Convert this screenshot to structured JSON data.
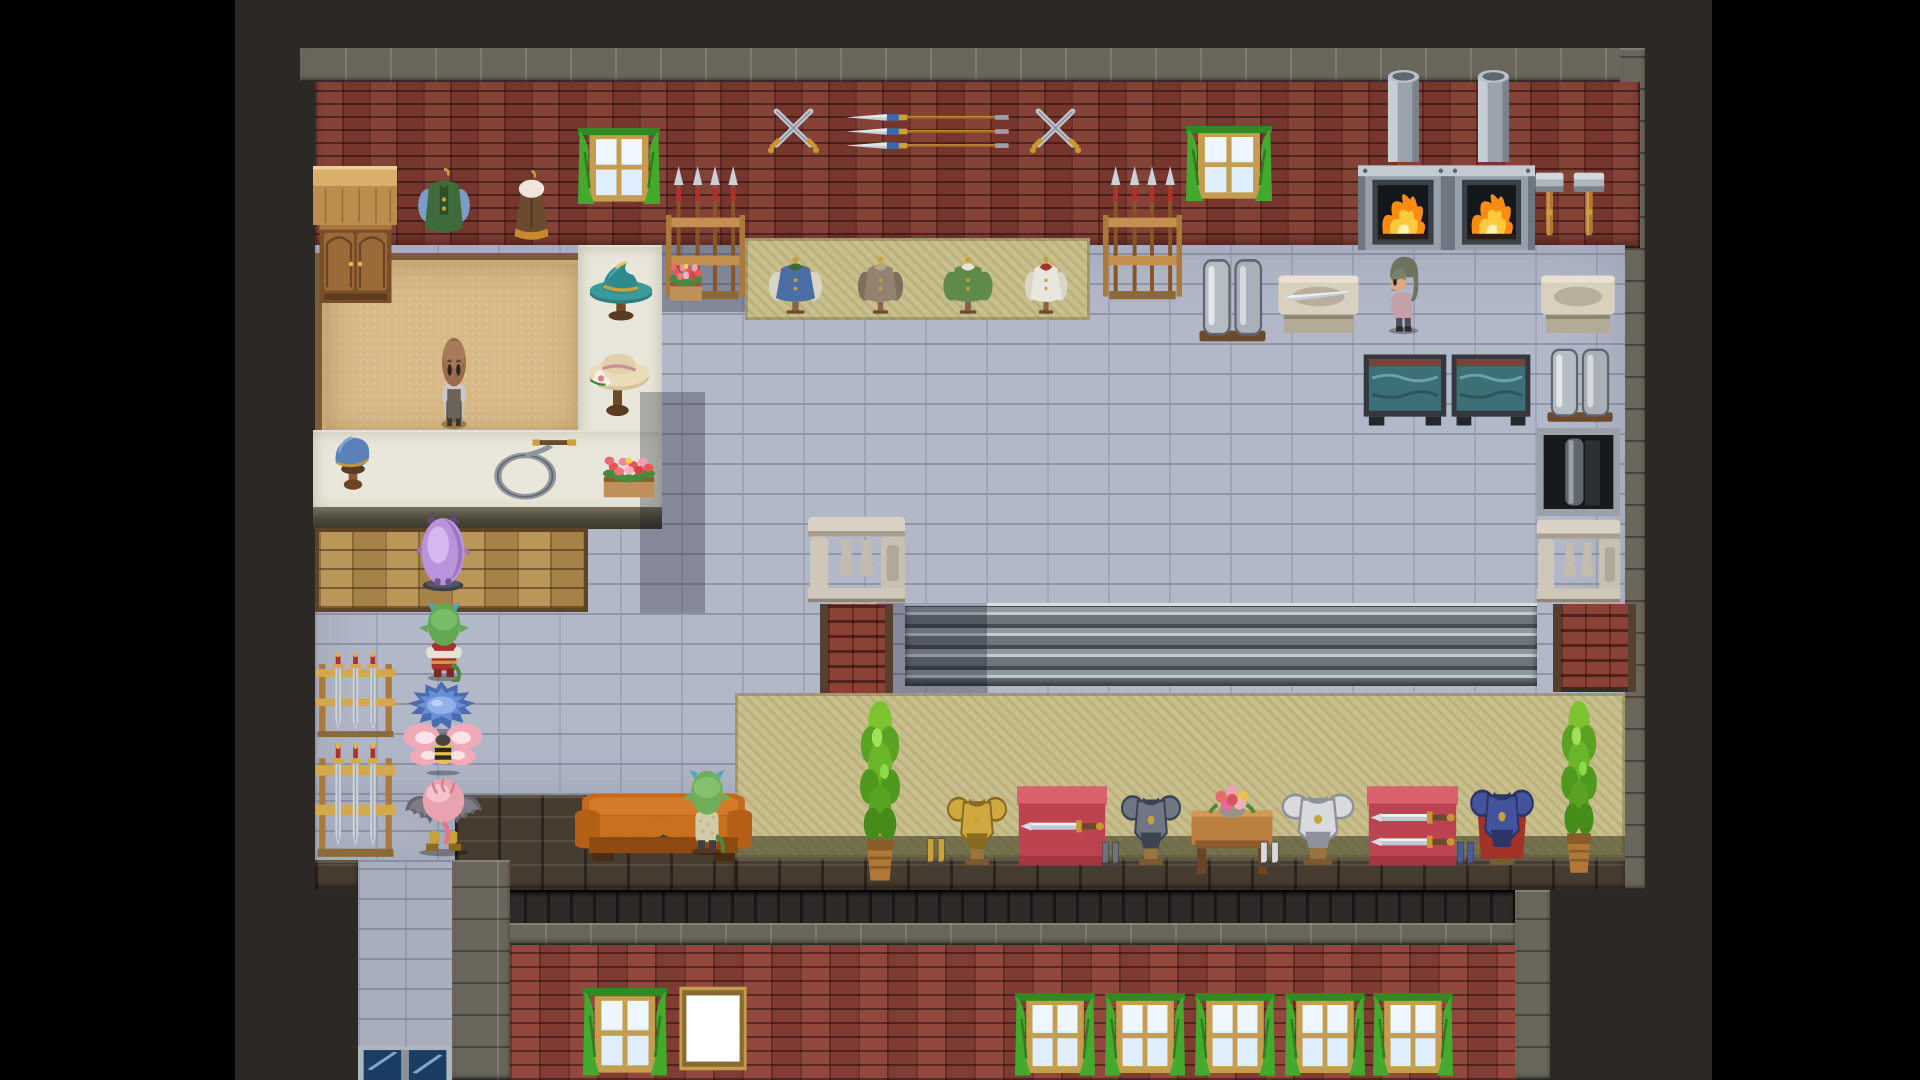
{
  "meta": {
    "screen": {
      "width": 1920,
      "height": 1080
    },
    "scene_kind": "top-down tile RPG shop interior (weapon / armor smithy)",
    "letterbox_color": "#000000"
  },
  "palette": {
    "outer_dark_brick": "#2b2826",
    "stone_trim": "#6a665c",
    "wall_red_brick": "#7d3a31",
    "floor_tile": "#b2b8c8",
    "carpet_tan": "#d7b988",
    "carpet_khaki": "#c8bf8c",
    "counter_white": "#e9e7db",
    "wood": "#9a6a38",
    "curtain_green": "#43aa2e",
    "fire_orange": "#ff8c12",
    "water_teal": "#3c6f76",
    "couch_orange": "#c2691e",
    "metal_gray": "#9aa1a7"
  },
  "scene": {
    "elements": [
      {
        "name": "letterbox-left",
        "type": "black",
        "x": 0,
        "y": 0,
        "w": 235,
        "h": 1080,
        "i": false
      },
      {
        "name": "letterbox-right",
        "type": "black",
        "x": 1712,
        "y": 0,
        "w": 208,
        "h": 1080,
        "i": false
      },
      {
        "name": "outer-wall-dark-brick",
        "type": "darkbrick",
        "x": 235,
        "y": 0,
        "w": 1477,
        "h": 1080,
        "i": false
      },
      {
        "name": "building-top-trim",
        "type": "trim",
        "x": 300,
        "y": 48,
        "w": 1345,
        "h": 34,
        "i": false
      },
      {
        "name": "right-trim-column",
        "type": "trim",
        "x": 1620,
        "y": 48,
        "w": 25,
        "h": 842,
        "i": false
      },
      {
        "name": "upper-wall-red-brick",
        "type": "redbrick",
        "x": 315,
        "y": 82,
        "w": 1325,
        "h": 166,
        "i": false
      },
      {
        "name": "main-floor",
        "type": "floor",
        "x": 315,
        "y": 245,
        "w": 1310,
        "h": 550,
        "i": false
      },
      {
        "name": "floor-extension-left",
        "type": "floor",
        "x": 315,
        "y": 795,
        "w": 140,
        "h": 67,
        "i": false
      },
      {
        "name": "walkway-south",
        "type": "floor2",
        "x": 358,
        "y": 862,
        "w": 94,
        "h": 218,
        "i": false
      },
      {
        "name": "bottom-ledge-left",
        "type": "ledgebrick",
        "x": 455,
        "y": 795,
        "w": 280,
        "h": 95,
        "i": false
      },
      {
        "name": "bottom-ledge-stub",
        "type": "ledgebrick",
        "x": 315,
        "y": 860,
        "w": 43,
        "h": 30,
        "i": false
      },
      {
        "name": "bottom-ledge-right",
        "type": "ledgebrick",
        "x": 735,
        "y": 858,
        "w": 890,
        "h": 32,
        "i": false
      },
      {
        "name": "bottom-planked-band",
        "type": "planks",
        "x": 455,
        "y": 890,
        "w": 1060,
        "h": 33,
        "i": false
      },
      {
        "name": "bottom-trim-row",
        "type": "trim",
        "x": 455,
        "y": 923,
        "w": 1060,
        "h": 22,
        "i": false
      },
      {
        "name": "walkway-trim-column",
        "type": "trim",
        "x": 452,
        "y": 860,
        "w": 58,
        "h": 220,
        "i": false
      },
      {
        "name": "bottom-right-trim-column",
        "type": "trim",
        "x": 1515,
        "y": 890,
        "w": 35,
        "h": 190,
        "i": false
      },
      {
        "name": "bottom-wall-red-brick",
        "type": "redbrick2",
        "x": 510,
        "y": 945,
        "w": 1005,
        "h": 135,
        "i": false
      },
      {
        "name": "wall-shadow-left",
        "type": "shadow",
        "x": 660,
        "y": 245,
        "w": 92,
        "h": 67,
        "i": false
      },
      {
        "name": "clothing-carpet",
        "type": "khaki",
        "x": 745,
        "y": 238,
        "w": 345,
        "h": 82,
        "i": false
      },
      {
        "name": "shop-carpet-tan",
        "type": "tancarpet",
        "x": 315,
        "y": 253,
        "w": 263,
        "h": 179,
        "i": false
      },
      {
        "name": "counter-vertical",
        "type": "whitecounter",
        "x": 578,
        "y": 245,
        "w": 84,
        "h": 267,
        "i": false
      },
      {
        "name": "counter-horizontal",
        "type": "whitecounter",
        "x": 313,
        "y": 430,
        "w": 349,
        "h": 82,
        "i": false
      },
      {
        "name": "counter-front-edge",
        "type": "counterfront",
        "x": 313,
        "y": 507,
        "w": 349,
        "h": 22,
        "i": false
      },
      {
        "name": "wood-mat-area",
        "type": "mat",
        "x": 315,
        "y": 528,
        "w": 265,
        "h": 76,
        "i": false
      },
      {
        "name": "counter-shadow-east",
        "type": "shadow",
        "x": 640,
        "y": 392,
        "w": 65,
        "h": 221,
        "i": false
      },
      {
        "name": "wood-counter-top",
        "type": "woodcounter",
        "x": 313,
        "y": 166,
        "w": 84,
        "h": 59,
        "i": false
      },
      {
        "name": "cabinet",
        "type": "cabinet",
        "x": 318,
        "y": 225,
        "w": 75,
        "h": 78,
        "i": false
      },
      {
        "name": "hanging-vest-display",
        "type": "vest",
        "x": 410,
        "y": 168,
        "w": 68,
        "h": 75,
        "i": false
      },
      {
        "name": "hanging-cape-display",
        "type": "cape",
        "x": 505,
        "y": 170,
        "w": 53,
        "h": 75,
        "i": false
      },
      {
        "name": "window-top-left",
        "type": "win",
        "x": 578,
        "y": 128,
        "w": 82,
        "h": 80,
        "i": false
      },
      {
        "name": "window-top-right",
        "type": "win",
        "x": 1186,
        "y": 126,
        "w": 86,
        "h": 79,
        "i": false
      },
      {
        "name": "crossed-swords-decor-1",
        "type": "xswords",
        "x": 763,
        "y": 98,
        "w": 61,
        "h": 60,
        "i": false
      },
      {
        "name": "wall-spears-decor",
        "type": "wallspears",
        "x": 843,
        "y": 108,
        "w": 169,
        "h": 47,
        "i": false
      },
      {
        "name": "crossed-swords-decor-2",
        "type": "xswords",
        "x": 1025,
        "y": 98,
        "w": 61,
        "h": 60,
        "i": false
      },
      {
        "name": "spear-rack-left",
        "type": "spearrack",
        "x": 666,
        "y": 166,
        "w": 79,
        "h": 136,
        "i": false
      },
      {
        "name": "spear-rack-right",
        "type": "spearrack",
        "x": 1103,
        "y": 166,
        "w": 79,
        "h": 136,
        "i": false
      },
      {
        "name": "furnace-chimney-1",
        "type": "chimney",
        "x": 1385,
        "y": 70,
        "w": 37,
        "h": 92,
        "i": false
      },
      {
        "name": "furnace-chimney-2",
        "type": "chimney",
        "x": 1475,
        "y": 70,
        "w": 37,
        "h": 92,
        "i": false
      },
      {
        "name": "furnace-1",
        "type": "furnace",
        "x": 1358,
        "y": 160,
        "w": 90,
        "h": 90,
        "i": false
      },
      {
        "name": "furnace-2",
        "type": "furnace",
        "x": 1448,
        "y": 160,
        "w": 87,
        "h": 90,
        "i": false
      },
      {
        "name": "wall-hammer-1",
        "type": "hammer",
        "x": 1532,
        "y": 170,
        "w": 35,
        "h": 68,
        "i": false
      },
      {
        "name": "wall-hammer-2",
        "type": "hammer",
        "x": 1570,
        "y": 170,
        "w": 38,
        "h": 68,
        "i": false
      },
      {
        "name": "mannequin-blue-tunic",
        "type": "mann",
        "x": 763,
        "y": 255,
        "w": 65,
        "h": 60,
        "i": false,
        "colors": {
          "body": "#4a6fa5",
          "sleeve": "#d8d4c8",
          "collar": "#3f6b3a"
        }
      },
      {
        "name": "mannequin-brown-robe",
        "type": "mann",
        "x": 853,
        "y": 255,
        "w": 55,
        "h": 60,
        "i": false,
        "colors": {
          "body": "#93826f",
          "sleeve": "#7e6e5c",
          "collar": "#b4a48e"
        }
      },
      {
        "name": "mannequin-green-coat",
        "type": "mann",
        "x": 938,
        "y": 255,
        "w": 60,
        "h": 60,
        "i": false,
        "colors": {
          "body": "#5f8a4a",
          "sleeve": "#5f8a4a",
          "collar": "#e8e4d4"
        }
      },
      {
        "name": "mannequin-white-dress",
        "type": "mann",
        "x": 1020,
        "y": 255,
        "w": 52,
        "h": 60,
        "i": false,
        "colors": {
          "body": "#e8e6dd",
          "sleeve": "#d8d5c9",
          "collar": "#a33226"
        }
      },
      {
        "name": "hat-stand-teal-hat",
        "type": "hatteal",
        "x": 582,
        "y": 254,
        "w": 78,
        "h": 70,
        "i": false
      },
      {
        "name": "hat-stand-sun-hat",
        "type": "hatsun",
        "x": 580,
        "y": 340,
        "w": 75,
        "h": 80,
        "i": false
      },
      {
        "name": "flower-planter-wall",
        "type": "flowerbox",
        "x": 664,
        "y": 250,
        "w": 44,
        "h": 55,
        "i": false
      },
      {
        "name": "ingot-stand-1",
        "type": "ingots",
        "x": 1195,
        "y": 255,
        "w": 75,
        "h": 90,
        "i": false
      },
      {
        "name": "work-table-with-blade",
        "type": "wtable",
        "x": 1275,
        "y": 270,
        "w": 87,
        "h": 70,
        "i": false,
        "colors": {
          "blade": 1
        }
      },
      {
        "name": "work-table-2",
        "type": "wtable",
        "x": 1538,
        "y": 270,
        "w": 80,
        "h": 70,
        "i": false
      },
      {
        "name": "quench-tank-1",
        "type": "tank",
        "x": 1362,
        "y": 353,
        "w": 86,
        "h": 74,
        "i": false
      },
      {
        "name": "quench-tank-2",
        "type": "tank",
        "x": 1450,
        "y": 353,
        "w": 82,
        "h": 74,
        "i": false
      },
      {
        "name": "ingot-stand-2",
        "type": "ingots",
        "x": 1543,
        "y": 345,
        "w": 74,
        "h": 80,
        "i": false
      },
      {
        "name": "forge-pit",
        "type": "forgepit",
        "x": 1537,
        "y": 428,
        "w": 83,
        "h": 88,
        "i": false
      },
      {
        "name": "metal-shutter-counter",
        "type": "shutter",
        "x": 905,
        "y": 603,
        "w": 632,
        "h": 83,
        "i": false
      },
      {
        "name": "shutter-shadow",
        "type": "shadow",
        "x": 877,
        "y": 603,
        "w": 110,
        "h": 90,
        "i": false
      },
      {
        "name": "balustrade-center",
        "type": "balustrade",
        "x": 806,
        "y": 515,
        "w": 101,
        "h": 89,
        "i": false
      },
      {
        "name": "brick-column-center",
        "type": "brickcol",
        "x": 820,
        "y": 604,
        "w": 57,
        "h": 94,
        "i": false
      },
      {
        "name": "balustrade-right",
        "type": "balustrade",
        "x": 1535,
        "y": 518,
        "w": 87,
        "h": 86,
        "i": false
      },
      {
        "name": "brick-column-right",
        "type": "brickcol",
        "x": 1553,
        "y": 604,
        "w": 67,
        "h": 88,
        "i": false
      },
      {
        "name": "display-carpet-bottom",
        "type": "khaki2",
        "x": 735,
        "y": 693,
        "w": 890,
        "h": 165,
        "i": false
      },
      {
        "name": "potted-plant-1",
        "type": "plant",
        "x": 843,
        "y": 700,
        "w": 74,
        "h": 188,
        "i": false
      },
      {
        "name": "boots-gold",
        "type": "boots",
        "x": 925,
        "y": 836,
        "w": 22,
        "h": 32,
        "i": false,
        "colors": {
          "c": "#c9a23a"
        }
      },
      {
        "name": "armor-display-gold",
        "type": "armor",
        "x": 944,
        "y": 780,
        "w": 66,
        "h": 86,
        "i": false,
        "colors": {
          "main": "#cfa93f",
          "dark": "#8a6a1e"
        }
      },
      {
        "name": "display-table-one-sword",
        "type": "rtable",
        "x": 1017,
        "y": 781,
        "w": 90,
        "h": 87,
        "i": false,
        "colors": {
          "swords": 1
        }
      },
      {
        "name": "boots-steel",
        "type": "boots",
        "x": 1100,
        "y": 840,
        "w": 21,
        "h": 28,
        "i": false,
        "colors": {
          "c": "#6d7380"
        }
      },
      {
        "name": "armor-display-steel",
        "type": "armor",
        "x": 1118,
        "y": 778,
        "w": 66,
        "h": 88,
        "i": false,
        "colors": {
          "main": "#707684",
          "dark": "#3d4350"
        }
      },
      {
        "name": "flower-vase-table",
        "type": "ftable",
        "x": 1186,
        "y": 781,
        "w": 92,
        "h": 99,
        "i": false
      },
      {
        "name": "boots-white",
        "type": "boots",
        "x": 1258,
        "y": 840,
        "w": 23,
        "h": 28,
        "i": false,
        "colors": {
          "c": "#d8d9dd"
        }
      },
      {
        "name": "armor-display-white",
        "type": "armor",
        "x": 1278,
        "y": 776,
        "w": 80,
        "h": 90,
        "i": false,
        "colors": {
          "main": "#d9dade",
          "dark": "#8f919c"
        }
      },
      {
        "name": "display-table-two-swords",
        "type": "rtable",
        "x": 1367,
        "y": 781,
        "w": 91,
        "h": 87,
        "i": false,
        "colors": {
          "swords": 2
        }
      },
      {
        "name": "boots-blue",
        "type": "boots",
        "x": 1455,
        "y": 840,
        "w": 21,
        "h": 28,
        "i": false,
        "colors": {
          "c": "#4a5a9a"
        }
      },
      {
        "name": "armor-display-blue-caped",
        "type": "armor",
        "x": 1467,
        "y": 771,
        "w": 70,
        "h": 95,
        "i": false,
        "colors": {
          "main": "#44549c",
          "dark": "#2c3567",
          "cape": "#a33226"
        }
      },
      {
        "name": "potted-plant-2",
        "type": "plant",
        "x": 1546,
        "y": 700,
        "w": 66,
        "h": 180,
        "i": false
      },
      {
        "name": "window-bottom-left",
        "type": "win",
        "x": 583,
        "y": 988,
        "w": 84,
        "h": 92,
        "i": false
      },
      {
        "name": "window-white-blank",
        "type": "whitewin",
        "x": 678,
        "y": 985,
        "w": 70,
        "h": 87,
        "i": false
      },
      {
        "name": "window-bottom-1",
        "type": "win",
        "x": 1015,
        "y": 993,
        "w": 80,
        "h": 87,
        "i": false
      },
      {
        "name": "window-bottom-2",
        "type": "win",
        "x": 1105,
        "y": 993,
        "w": 80,
        "h": 87,
        "i": false
      },
      {
        "name": "window-bottom-3",
        "type": "win",
        "x": 1195,
        "y": 993,
        "w": 80,
        "h": 87,
        "i": false
      },
      {
        "name": "window-bottom-4",
        "type": "win",
        "x": 1285,
        "y": 993,
        "w": 80,
        "h": 87,
        "i": false
      },
      {
        "name": "window-bottom-5",
        "type": "win",
        "x": 1373,
        "y": 993,
        "w": 80,
        "h": 87,
        "i": false
      },
      {
        "name": "glass-double-doors",
        "type": "doors",
        "x": 358,
        "y": 1046,
        "w": 94,
        "h": 34,
        "i": true
      },
      {
        "name": "sword-rack-1",
        "type": "swordrack",
        "x": 316,
        "y": 652,
        "w": 79,
        "h": 86,
        "i": false
      },
      {
        "name": "sword-rack-2",
        "type": "swordrack",
        "x": 316,
        "y": 742,
        "w": 79,
        "h": 116,
        "i": false
      },
      {
        "name": "hat-stand-blue-beret",
        "type": "hatberet",
        "x": 326,
        "y": 430,
        "w": 54,
        "h": 65,
        "i": false
      },
      {
        "name": "whip-on-counter",
        "type": "whip",
        "x": 487,
        "y": 436,
        "w": 91,
        "h": 69,
        "i": false
      },
      {
        "name": "flower-box-counter",
        "type": "flowerbox",
        "x": 594,
        "y": 443,
        "w": 70,
        "h": 59,
        "i": false
      },
      {
        "name": "couch",
        "type": "couch",
        "x": 575,
        "y": 786,
        "w": 177,
        "h": 80,
        "i": true
      },
      {
        "name": "npc-goblin-at-couch",
        "type": "couchgoblin",
        "x": 675,
        "y": 768,
        "w": 64,
        "h": 88,
        "i": true
      },
      {
        "name": "npc-shopkeeper-bald",
        "type": "shopkeeper",
        "x": 430,
        "y": 333,
        "w": 48,
        "h": 97,
        "i": true
      },
      {
        "name": "npc-blacksmith-woman",
        "type": "smith",
        "x": 1373,
        "y": 250,
        "w": 61,
        "h": 85,
        "i": true
      },
      {
        "name": "npc-purple-fluff-creature",
        "type": "purplefluff",
        "x": 413,
        "y": 508,
        "w": 60,
        "h": 84,
        "i": true
      },
      {
        "name": "npc-red-clad-goblin",
        "type": "goblinred",
        "x": 413,
        "y": 600,
        "w": 62,
        "h": 82,
        "i": true
      },
      {
        "name": "npc-blue-spiky-creature",
        "type": "bluespiky",
        "x": 405,
        "y": 680,
        "w": 73,
        "h": 55,
        "i": true
      },
      {
        "name": "npc-bee-fairy",
        "type": "beefairy",
        "x": 402,
        "y": 715,
        "w": 82,
        "h": 63,
        "i": true
      },
      {
        "name": "npc-bat-winged-imp",
        "type": "batimp",
        "x": 400,
        "y": 768,
        "w": 87,
        "h": 90,
        "i": true
      }
    ]
  }
}
